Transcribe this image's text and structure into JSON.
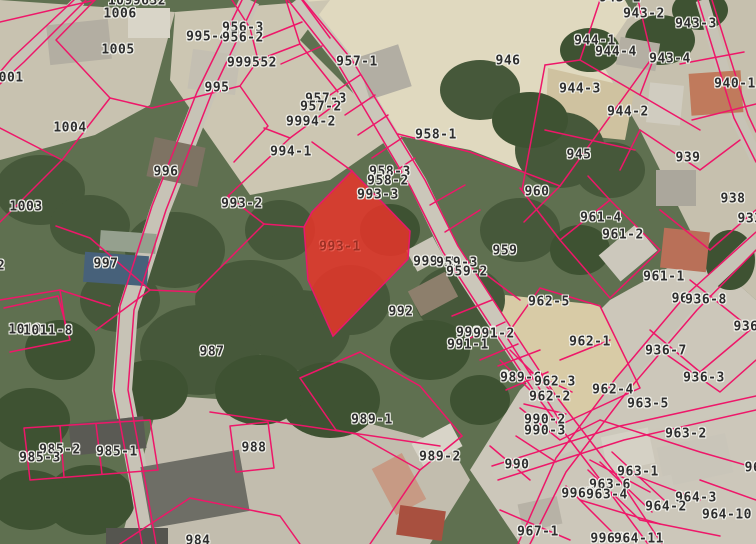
{
  "map": {
    "description": "cadastral parcel map over aerial photo",
    "boundary_line_color": "#ee1769",
    "label_text_color": "#2e2e2e",
    "label_halo_color": "#f2f2ec",
    "highlight_parcel": {
      "id": "993-1",
      "fill": "#e8352a",
      "fill_opacity": 0.85,
      "stroke": "#e8186d",
      "label_color": "#9c2f24",
      "points": "352,171 410,231 408,259 333,336 308,280 304,227 312,212",
      "label_x": 340,
      "label_y": 247
    },
    "labels": [
      {
        "t": "1099632",
        "x": 137,
        "y": 1
      },
      {
        "t": "943-1",
        "x": 620,
        "y": -2
      },
      {
        "t": "1006",
        "x": 120,
        "y": 14
      },
      {
        "t": "943-2",
        "x": 644,
        "y": 14
      },
      {
        "t": "943-3",
        "x": 696,
        "y": 24
      },
      {
        "t": "956-3",
        "x": 243,
        "y": 28
      },
      {
        "t": "995-4",
        "x": 207,
        "y": 37
      },
      {
        "t": "956-2",
        "x": 243,
        "y": 38
      },
      {
        "t": "944-1",
        "x": 595,
        "y": 41
      },
      {
        "t": "1005",
        "x": 118,
        "y": 50
      },
      {
        "t": "944-4",
        "x": 616,
        "y": 52
      },
      {
        "t": "943-4",
        "x": 670,
        "y": 59
      },
      {
        "t": "946",
        "x": 508,
        "y": 61
      },
      {
        "t": "957-1",
        "x": 357,
        "y": 62
      },
      {
        "t": "999552",
        "x": 252,
        "y": 63
      },
      {
        "t": "1001",
        "x": 7,
        "y": 78
      },
      {
        "t": "940-1",
        "x": 735,
        "y": 84
      },
      {
        "t": "995",
        "x": 217,
        "y": 88
      },
      {
        "t": "944-3",
        "x": 580,
        "y": 89
      },
      {
        "t": "957-3",
        "x": 326,
        "y": 99
      },
      {
        "t": "957-2",
        "x": 321,
        "y": 107
      },
      {
        "t": "944-2",
        "x": 628,
        "y": 112
      },
      {
        "t": "9994-2",
        "x": 311,
        "y": 122
      },
      {
        "t": "1004",
        "x": 70,
        "y": 128
      },
      {
        "t": "958-1",
        "x": 436,
        "y": 135
      },
      {
        "t": "994-1",
        "x": 291,
        "y": 152
      },
      {
        "t": "945",
        "x": 579,
        "y": 155
      },
      {
        "t": "939",
        "x": 688,
        "y": 158
      },
      {
        "t": "996",
        "x": 166,
        "y": 172
      },
      {
        "t": "958-3",
        "x": 390,
        "y": 172
      },
      {
        "t": "958-2",
        "x": 388,
        "y": 181
      },
      {
        "t": "960",
        "x": 537,
        "y": 192
      },
      {
        "t": "993-3",
        "x": 378,
        "y": 195
      },
      {
        "t": "938",
        "x": 733,
        "y": 199
      },
      {
        "t": "993-2",
        "x": 242,
        "y": 204
      },
      {
        "t": "1003",
        "x": 26,
        "y": 207
      },
      {
        "t": "961-4",
        "x": 601,
        "y": 218
      },
      {
        "t": "933",
        "x": 750,
        "y": 219
      },
      {
        "t": "961-2",
        "x": 623,
        "y": 235
      },
      {
        "t": "959",
        "x": 505,
        "y": 251
      },
      {
        "t": "999-2",
        "x": 434,
        "y": 262
      },
      {
        "t": "959-3",
        "x": 457,
        "y": 263
      },
      {
        "t": "2",
        "x": 1,
        "y": 266
      },
      {
        "t": "997",
        "x": 106,
        "y": 264
      },
      {
        "t": "959-2",
        "x": 467,
        "y": 272
      },
      {
        "t": "961-1",
        "x": 664,
        "y": 277
      },
      {
        "t": "96",
        "x": 680,
        "y": 299
      },
      {
        "t": "936-8",
        "x": 706,
        "y": 300
      },
      {
        "t": "962-5",
        "x": 549,
        "y": 302
      },
      {
        "t": "992",
        "x": 401,
        "y": 312
      },
      {
        "t": "936",
        "x": 746,
        "y": 327
      },
      {
        "t": "1010",
        "x": 25,
        "y": 330
      },
      {
        "t": "1011-8",
        "x": 48,
        "y": 331
      },
      {
        "t": "999-1",
        "x": 477,
        "y": 333
      },
      {
        "t": "991-2",
        "x": 494,
        "y": 334
      },
      {
        "t": "962-1",
        "x": 590,
        "y": 342
      },
      {
        "t": "991-1",
        "x": 468,
        "y": 345
      },
      {
        "t": "936-7",
        "x": 666,
        "y": 351
      },
      {
        "t": "987",
        "x": 212,
        "y": 352
      },
      {
        "t": "9",
        "x": 505,
        "y": 377
      },
      {
        "t": "989-6",
        "x": 521,
        "y": 378
      },
      {
        "t": "936-3",
        "x": 704,
        "y": 378
      },
      {
        "t": "962-3",
        "x": 555,
        "y": 382
      },
      {
        "t": "962-4",
        "x": 613,
        "y": 390
      },
      {
        "t": "962-2",
        "x": 550,
        "y": 397
      },
      {
        "t": "963-5",
        "x": 648,
        "y": 404
      },
      {
        "t": "989-1",
        "x": 372,
        "y": 420
      },
      {
        "t": "990-2",
        "x": 545,
        "y": 420
      },
      {
        "t": "990-3",
        "x": 545,
        "y": 431
      },
      {
        "t": "963-2",
        "x": 686,
        "y": 434
      },
      {
        "t": "988",
        "x": 254,
        "y": 448
      },
      {
        "t": "985-2",
        "x": 60,
        "y": 450
      },
      {
        "t": "985-1",
        "x": 117,
        "y": 452
      },
      {
        "t": "989-2",
        "x": 440,
        "y": 457
      },
      {
        "t": "985-3",
        "x": 40,
        "y": 458
      },
      {
        "t": "990",
        "x": 517,
        "y": 465
      },
      {
        "t": "96",
        "x": 753,
        "y": 468
      },
      {
        "t": "963-1",
        "x": 638,
        "y": 472
      },
      {
        "t": "963-6",
        "x": 610,
        "y": 485
      },
      {
        "t": "9967",
        "x": 578,
        "y": 494
      },
      {
        "t": "963-4",
        "x": 607,
        "y": 495
      },
      {
        "t": "964-3",
        "x": 696,
        "y": 498
      },
      {
        "t": "964-2",
        "x": 666,
        "y": 507
      },
      {
        "t": "964-10",
        "x": 727,
        "y": 515
      },
      {
        "t": "967-1",
        "x": 538,
        "y": 532
      },
      {
        "t": "9966",
        "x": 607,
        "y": 539
      },
      {
        "t": "964-11",
        "x": 639,
        "y": 539
      },
      {
        "t": "984",
        "x": 198,
        "y": 541
      }
    ]
  }
}
